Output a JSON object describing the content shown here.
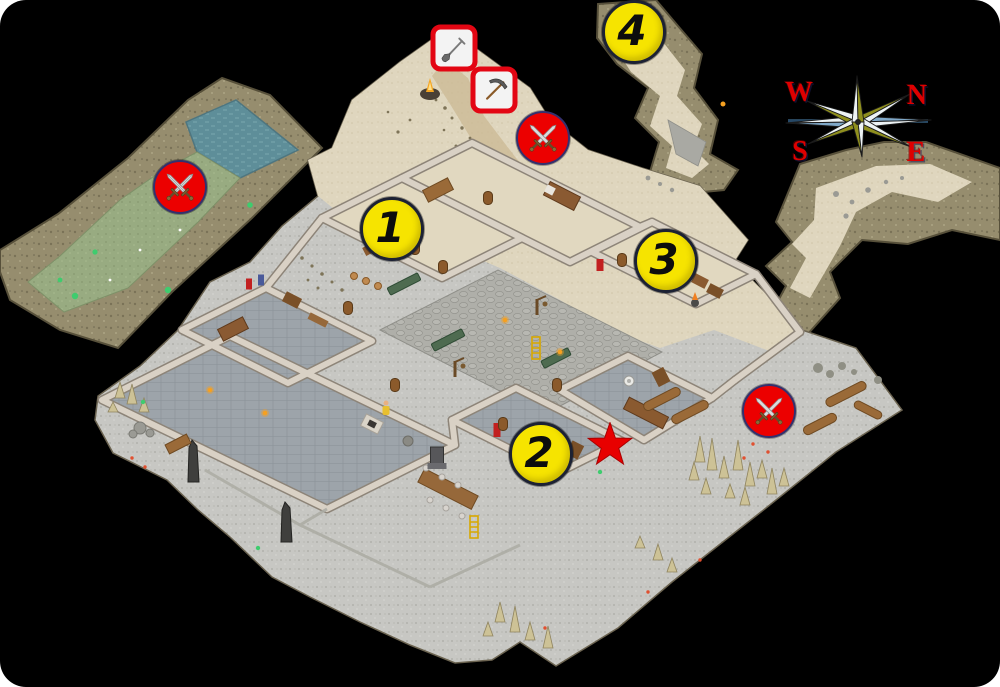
{
  "map": {
    "markers": {
      "numbered": [
        {
          "label": "1",
          "x": 392,
          "y": 229
        },
        {
          "label": "2",
          "x": 541,
          "y": 454
        },
        {
          "label": "3",
          "x": 666,
          "y": 261
        },
        {
          "label": "4",
          "x": 634,
          "y": 32
        }
      ],
      "battle": [
        {
          "icon": "crossed-swords-icon",
          "x": 180,
          "y": 187
        },
        {
          "icon": "crossed-swords-icon",
          "x": 543,
          "y": 138
        },
        {
          "icon": "crossed-swords-icon",
          "x": 769,
          "y": 411
        }
      ],
      "tools": [
        {
          "icon": "shovel-icon",
          "x": 454,
          "y": 48
        },
        {
          "icon": "pickaxe-icon",
          "x": 494,
          "y": 90
        }
      ],
      "star": {
        "icon": "star-icon",
        "x": 610,
        "y": 445
      }
    },
    "compass": {
      "directions": [
        {
          "label": "W",
          "x": 799,
          "y": 93
        },
        {
          "label": "N",
          "x": 917,
          "y": 96
        },
        {
          "label": "S",
          "x": 800,
          "y": 152
        },
        {
          "label": "E",
          "x": 916,
          "y": 153
        }
      ]
    },
    "palette": {
      "background": "#000000",
      "marker_yellow": "#F6E400",
      "marker_red": "#EC0000",
      "marker_outline": "#1C2133",
      "battle_outline": "#34306E",
      "tool_box_bg": "#F3F3F3",
      "tool_box_border": "#E30613",
      "star_red": "#E80000",
      "compass_olive": "#8F8F1E",
      "compass_light": "#EDF3F5",
      "compass_blue": "#7FA8C8",
      "compass_label_red": "#DE0000",
      "sand": "#DFD6BE",
      "rock": "#968D6E",
      "water": "#5E8E99",
      "moss": "#98AB81",
      "slate": "#9DA4AA",
      "cobblestone": "#AFAFA9",
      "outdoor_gray": "#C7C7C3",
      "wall_stone": "#D9D1C5",
      "wood": "#9A6A38"
    }
  }
}
